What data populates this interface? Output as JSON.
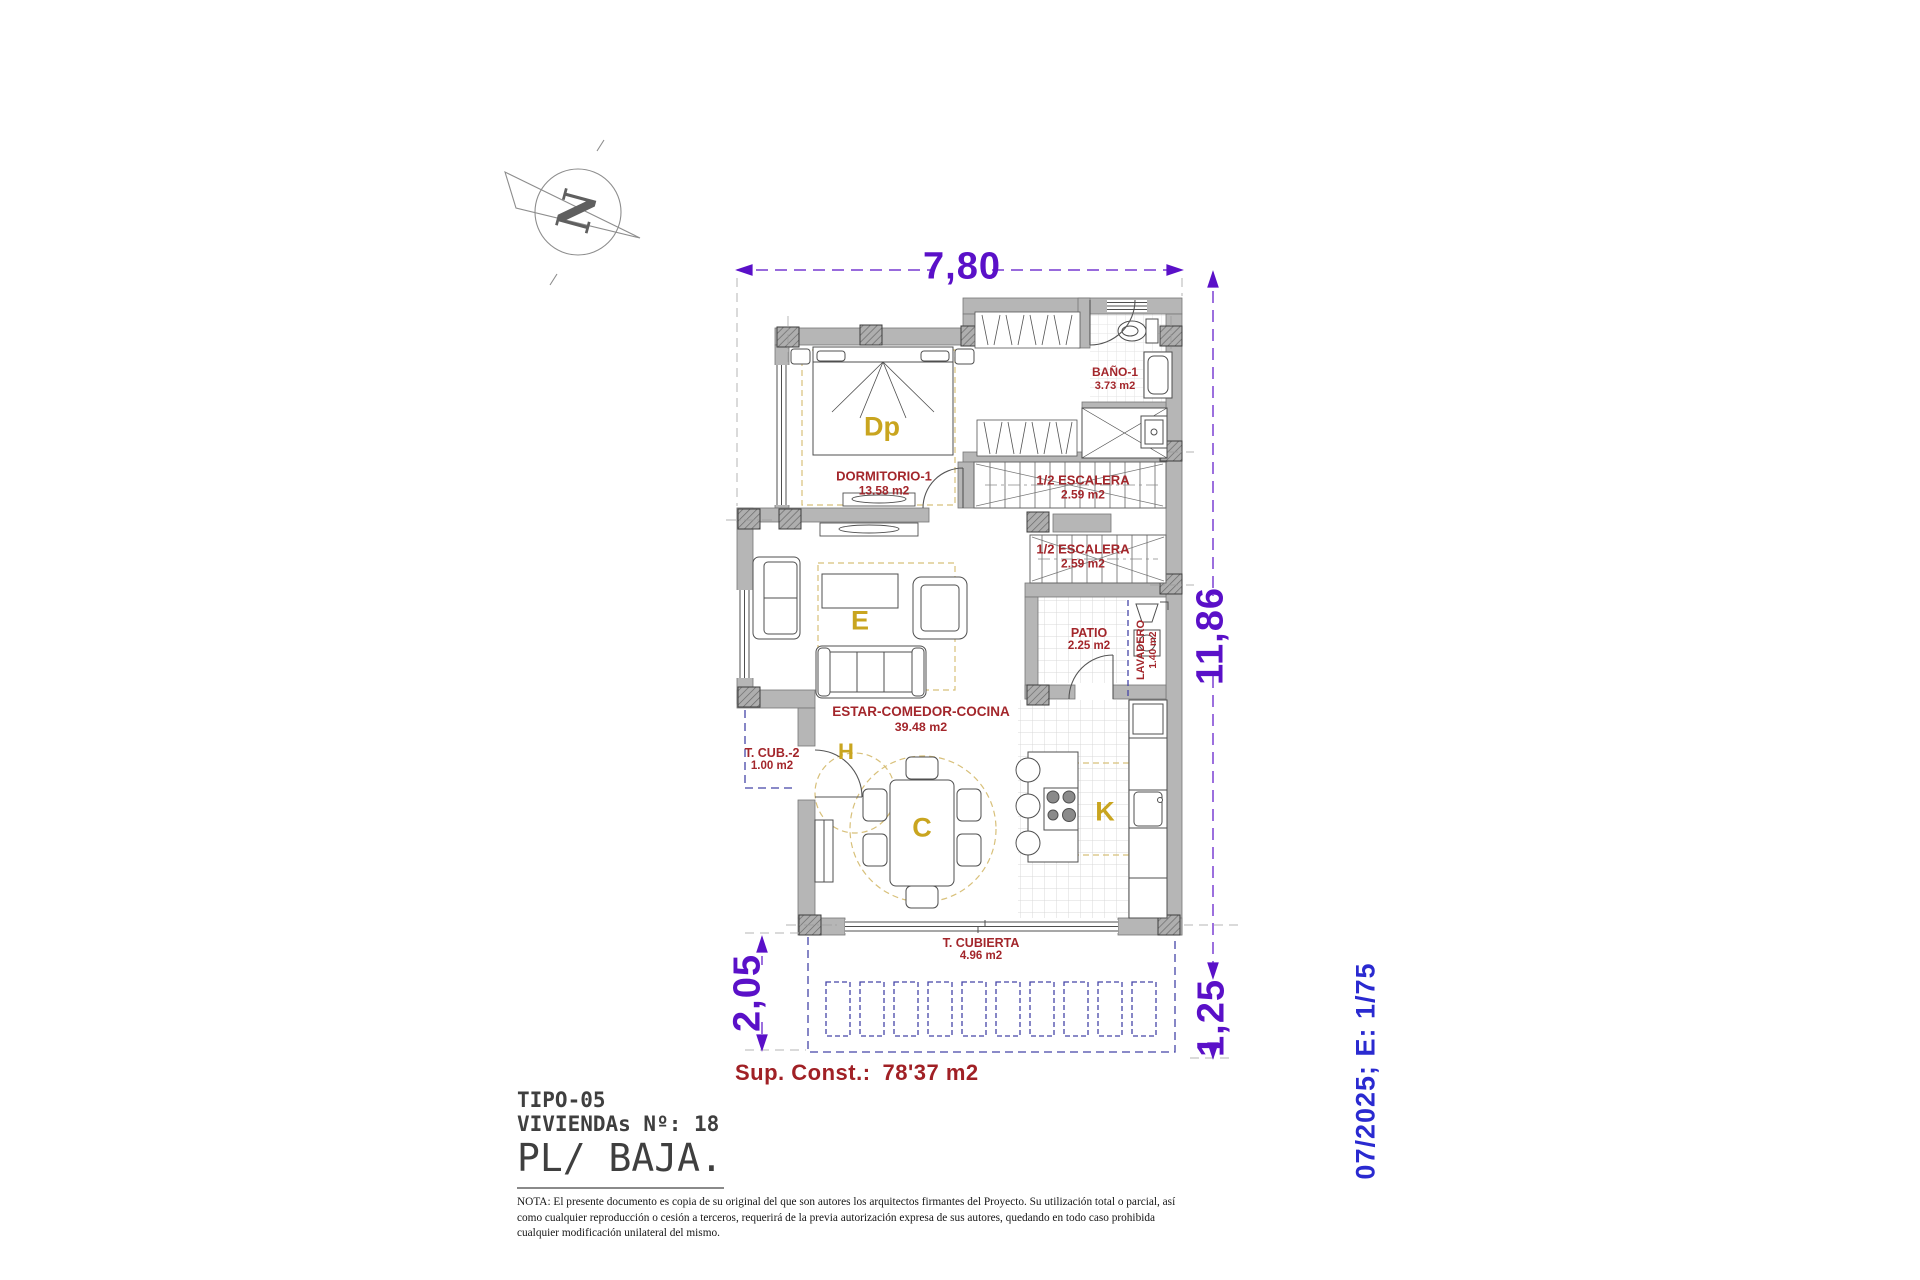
{
  "drawing": {
    "compass": {
      "letter": "N"
    },
    "dimensions": {
      "top_width": "7,80",
      "right_height": "11,86",
      "porch_depth_left": "2,05",
      "porch_depth_right": "1,25"
    },
    "rooms": [
      {
        "name": "BAÑO-1",
        "area": "3.73 m2"
      },
      {
        "name": "DORMITORIO-1",
        "area": "13.58 m2"
      },
      {
        "name": "1/2 ESCALERA",
        "area": "2.59 m2"
      },
      {
        "name": "1/2 ESCALERA",
        "area": "2.59 m2"
      },
      {
        "name": "PATIO",
        "area": "2.25 m2"
      },
      {
        "name": "LAVADERO",
        "area": "1.40 m2"
      },
      {
        "name": "ESTAR-COMEDOR-COCINA",
        "area": "39.48 m2"
      },
      {
        "name": "T. CUB.-2",
        "area": "1.00 m2"
      },
      {
        "name": "T. CUBIERTA",
        "area": "4.96 m2"
      }
    ],
    "zone_letters": [
      {
        "label": "Dp"
      },
      {
        "label": "E"
      },
      {
        "label": "H"
      },
      {
        "label": "C"
      },
      {
        "label": "K"
      }
    ],
    "summary": {
      "label": "Sup. Const.:",
      "value": "78'37 m2"
    }
  },
  "title_block": {
    "type_line": "TIPO-05",
    "dwellings_line": "VIVIENDAs Nº: 18",
    "floor_line": "PL/ BAJA.",
    "note_lines": [
      "NOTA: El presente documento es copia de su original del que son autores los arquitectos firmantes del Proyecto. Su utilización total o parcial, así",
      "como cualquier reproducción o cesión a terceros, requerirá  de la previa autorización expresa de sus autores, quedando en todo caso prohibida",
      "cualquier modificación unilateral del mismo."
    ]
  },
  "side_note": "07/2025; E: 1/75",
  "colors": {
    "dimension_purple": "#5a10c8",
    "room_label_red": "#a3262b",
    "zone_letter_yellow": "#c9a51f",
    "summary_red": "#a02025",
    "side_note_blue": "#2a2ad0",
    "pergola_blue": "#4545a8",
    "wall_gray": "#b6b6b6",
    "furniture_line": "#4f4f4f",
    "area_dash_tan": "#d8c07a"
  }
}
